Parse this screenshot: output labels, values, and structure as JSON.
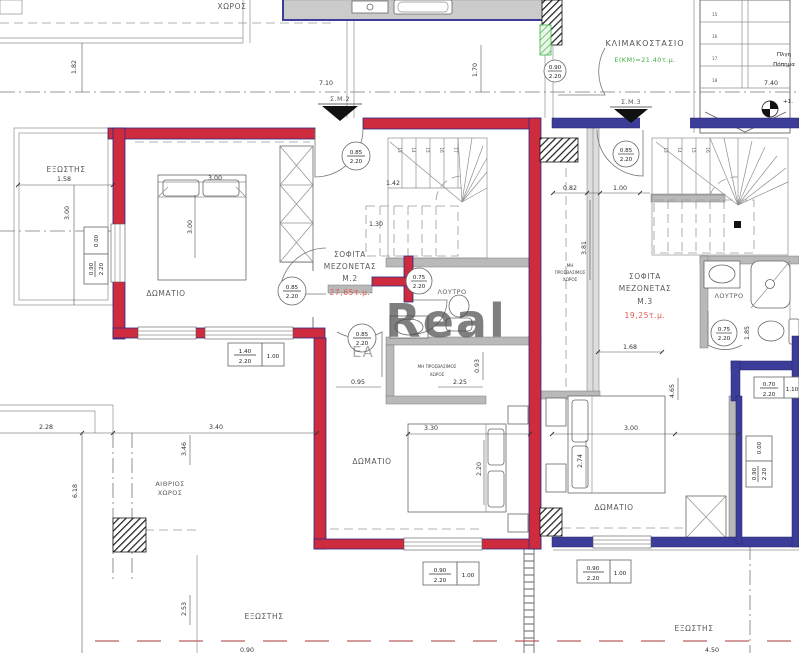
{
  "drawing": {
    "rooms": {
      "stairwell": {
        "name": "ΚΛΙΜΑΚΟΣΤΑΣΙΟ",
        "area": "Ε(ΚΜ)=21.40τ.μ."
      },
      "m2": {
        "l1": "ΣΟΦΙΤΑ",
        "l2": "ΜΕΖΟΝΕΤΑΣ",
        "l3": "Μ.2",
        "area": "27,65τ.μ."
      },
      "m3": {
        "l1": "ΣΟΦΙΤΑ",
        "l2": "ΜΕΖΟΝΕΤΑΣ",
        "l3": "Μ.3",
        "area": "19,25τ.μ."
      },
      "bedroom_m2_upper": "ΔΩΜΑΤΙΟ",
      "bedroom_m2_lower": "ΔΩΜΑΤΙΟ",
      "bedroom_m3": "ΔΩΜΑΤΙΟ",
      "bath_m2": "ΛΟΥΤΡΟ",
      "bath_m3": "ΛΟΥΤΡΟ",
      "balcony_left": "ΕΞΩΣΤΗΣ",
      "balcony_bottom": "ΕΞΩΣΤΗΣ",
      "balcony_bottom_right": "ΕΞΩΣΤΗΣ",
      "atrium": {
        "l1": "ΑΙΘΡΙΟΣ",
        "l2": "ΧΩΡΟΣ"
      },
      "top_partial": "ΧΩΡΟΣ",
      "closet": {
        "l1": "ΜΗ ΠΡΟΣΒΑΣΙΜΟΣ",
        "l2": "ΧΩΡΟΣ"
      },
      "shaft": {
        "l1": "ΜΗ",
        "l2": "ΠΡΟΣΒΑΣΙΜΟΣ",
        "l3": "ΧΩΡΟΣ"
      },
      "note": {
        "l1": "Πλγη",
        "l2": "Πόπημα"
      }
    },
    "markers": {
      "sm2": "Σ.Μ.2",
      "sm3": "Σ.Μ.3",
      "level": "+1."
    },
    "door_tags": {
      "c1": {
        "t": "0.85",
        "b": "2.20"
      },
      "c2": {
        "t": "0.85",
        "b": "2.20"
      },
      "c3": {
        "t": "0.75",
        "b": "2.20"
      },
      "c4": {
        "t": "0.85",
        "b": "2.20"
      },
      "c5": {
        "t": "0.85",
        "b": "2.20"
      },
      "c6": {
        "t": "0.75",
        "b": "2.20"
      },
      "c7": {
        "t": "0.90",
        "b": "2.20"
      }
    },
    "door_boxes": {
      "b1": {
        "t": "1.40",
        "b": "2.20",
        "s": "1.00"
      },
      "b2": {
        "t": "0.90",
        "b": "2.20",
        "s": "1.00"
      },
      "b3": {
        "t": "0.90",
        "b": "2.20",
        "s": "1.00"
      },
      "b4": {
        "a": "0.00",
        "t": "0.90",
        "b": "2.20"
      },
      "b5": {
        "a": "0.00",
        "t": "0.90",
        "b": "2.20"
      },
      "b6": {
        "t": "0.70",
        "b": "2.20",
        "s": "1.10"
      }
    },
    "dims": {
      "w710": "7.10",
      "w740": "7.40",
      "v182": "1.82",
      "v170": "1.70",
      "bal_w": "1.58",
      "bal_h": "3.00",
      "bed1_w": "3.00",
      "bed1_h": "3.00",
      "st142": "1.42",
      "st130": "1.30",
      "shaft_w": "0.82",
      "shaft_s": "1.00",
      "shaft_h": "3.81",
      "m3_168": "1.68",
      "m3_465": "4.65",
      "m3_185": "1.85",
      "a228": "2.28",
      "a340": "3.40",
      "d095": "0.95",
      "cl_w": "2.25",
      "cl_h": "0.93",
      "bed2_w": "3.30",
      "bed2_h": "2.20",
      "bed3_w": "3.00",
      "bed3_h": "2.74",
      "v618": "6.18",
      "v346": "3.46",
      "v253": "2.53",
      "bot_l": "0.90",
      "bot_r": "4.50"
    },
    "stairs": {
      "m2": [
        "13",
        "14",
        "15",
        "16",
        "17"
      ],
      "m3": [
        "13",
        "14",
        "15",
        "16"
      ],
      "tr": [
        "15",
        "16",
        "17",
        "18"
      ]
    },
    "watermark": {
      "main": "Real",
      "sub": "EA"
    },
    "colors": {
      "wall_red": "#ce2b3e",
      "wall_blue": "#3c3c99",
      "wall_gray": "#b9b9b9",
      "accent_green": "#3faf46",
      "area_text": "#e4584f",
      "watermark": "#d54545",
      "red_dash": "#cf8d8d"
    }
  }
}
